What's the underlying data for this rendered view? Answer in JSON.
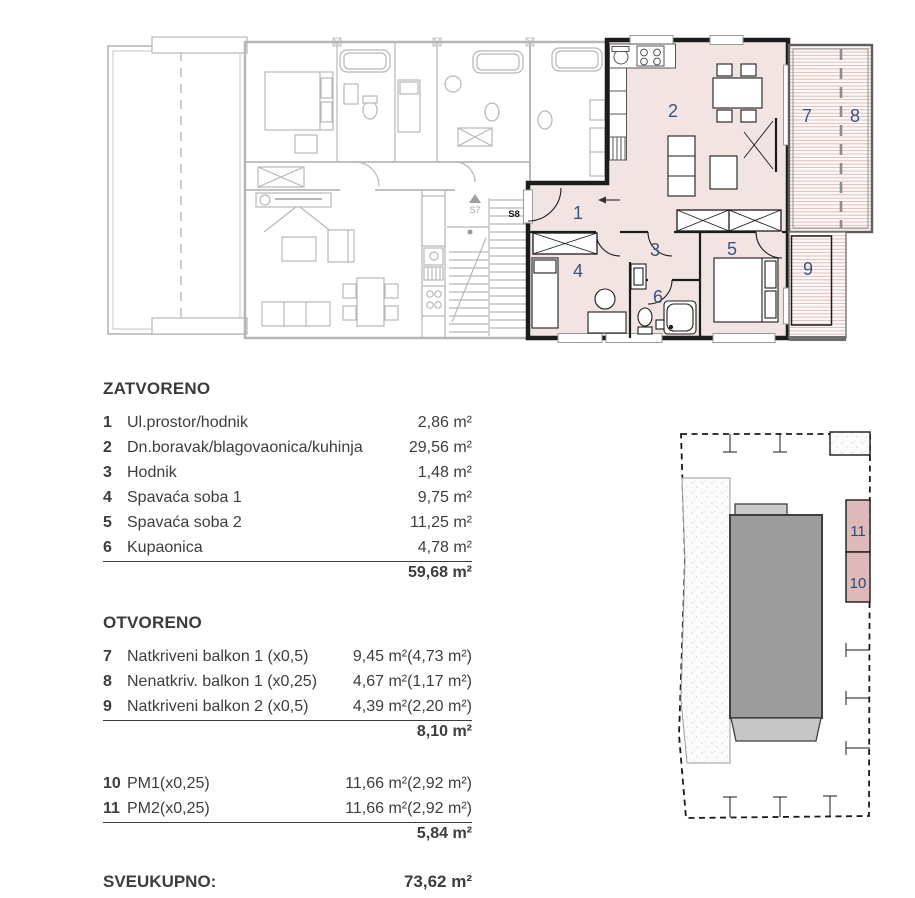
{
  "plan": {
    "room_numbers": [
      "1",
      "2",
      "3",
      "4",
      "5",
      "6",
      "7",
      "8",
      "9"
    ],
    "stair_up_label": "S7",
    "entry_label": "S8"
  },
  "site_plan": {
    "parking_numbers": [
      "11",
      "10"
    ]
  },
  "sections": {
    "zatvoreno": {
      "title": "ZATVORENO",
      "rows": [
        {
          "num": "1",
          "label": "Ul.prostor/hodnik",
          "value": "2,86 m²"
        },
        {
          "num": "2",
          "label": "Dn.boravak/blagovaonica/kuhinja",
          "value": "29,56 m²"
        },
        {
          "num": "3",
          "label": "Hodnik",
          "value": "1,48 m²"
        },
        {
          "num": "4",
          "label": "Spavaća soba 1",
          "value": "9,75 m²"
        },
        {
          "num": "5",
          "label": "Spavaća soba 2",
          "value": "11,25 m²"
        },
        {
          "num": "6",
          "label": "Kupaonica",
          "value": "4,78 m²"
        }
      ],
      "total": "59,68 m²"
    },
    "otvoreno": {
      "title": "OTVORENO",
      "rows": [
        {
          "num": "7",
          "label": "Natkriveni balkon 1 (x0,5)",
          "value": "9,45 m²(4,73 m²)"
        },
        {
          "num": "8",
          "label": "Nenatkriv. balkon 1 (x0,25)",
          "value": "4,67 m²(1,17 m²)"
        },
        {
          "num": "9",
          "label": "Natkriveni balkon 2 (x0,5)",
          "value": "4,39 m²(2,20 m²)"
        }
      ],
      "total": "8,10 m²"
    },
    "parking": {
      "rows": [
        {
          "num": "10",
          "label": "PM1(x0,25)",
          "value": "11,66 m²(2,92 m²)"
        },
        {
          "num": "11",
          "label": "PM2(x0,25)",
          "value": "11,66 m²(2,92 m²)"
        }
      ],
      "total": "5,84 m²"
    },
    "grand_total": {
      "label": "SVEUKUPNO:",
      "value": "73,62 m²"
    }
  },
  "colors": {
    "highlight_fill": "#f2e4e3",
    "wall_dark": "#1c1c1c",
    "neighbor_line": "#b7b7b7",
    "room_number_blue": "#3a5578",
    "site_number_blue": "#2d4a74",
    "text_dark": "#3d3d3d",
    "balcony_hatch_line": "#dcb9b6",
    "building_fill": "#9c9c9c",
    "parking_fill": "#ddbab9"
  }
}
